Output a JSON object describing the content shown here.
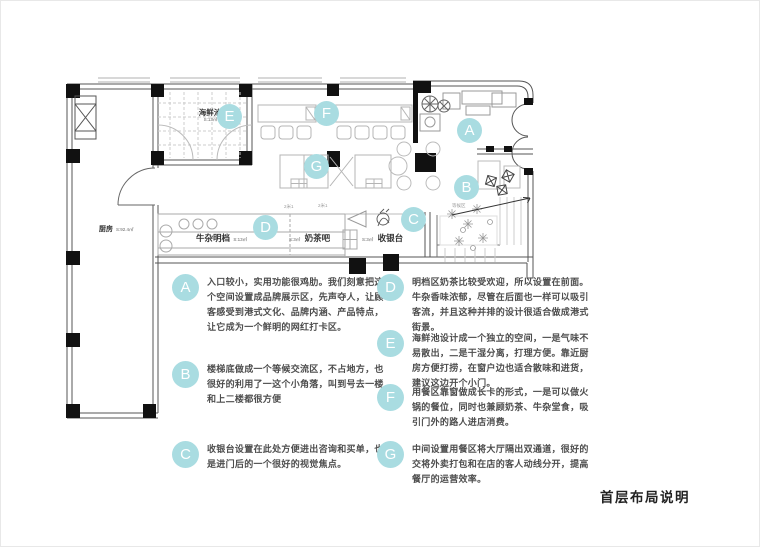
{
  "title": "首层布局说明",
  "plan": {
    "rooms": [
      {
        "name": "海鲜池",
        "area": "S:13㎡"
      },
      {
        "name": "厨房",
        "area": "S:92.4㎡"
      },
      {
        "name": "牛杂明档",
        "area": "S:13㎡"
      },
      {
        "name": "奶茶吧",
        "area": "S:3㎡"
      },
      {
        "name": "收银台",
        "area": "S:3㎡"
      }
    ],
    "markers": [
      {
        "letter": "A"
      },
      {
        "letter": "B"
      },
      {
        "letter": "C"
      },
      {
        "letter": "D"
      },
      {
        "letter": "E"
      },
      {
        "letter": "F"
      },
      {
        "letter": "G"
      }
    ],
    "tiny_labels": {
      "dim_left": "2米1",
      "dim_right": "2米1",
      "stairs_note": "等候区"
    }
  },
  "annotations": [
    {
      "letter": "A",
      "text": "入口较小，实用功能很鸡肋。我们刻意把这个空间设置成品牌展示区，先声夺人，让顾客感受到港式文化、品牌内涵、产品特点，让它成为一个鲜明的网红打卡区。"
    },
    {
      "letter": "B",
      "text": "楼梯底做成一个等候交流区，不占地方，也很好的利用了一这个小角落，叫到号去一楼和上二楼都很方便"
    },
    {
      "letter": "C",
      "text": "收银台设置在此处方便进出咨询和买单，也是进门后的一个很好的视觉焦点。"
    },
    {
      "letter": "D",
      "text": "明档区奶茶比较受欢迎，所以设置在前面。牛杂香味浓郁，尽管在后面也一样可以吸引客流，并且这种并排的设计很适合做成港式街景。"
    },
    {
      "letter": "E",
      "text": "海鲜池设计成一个独立的空间，一是气味不易散出，二是干湿分离，打理方便。靠近厨房方便打捞，在窗户边也适合散味和进货，建议这边开个小门。"
    },
    {
      "letter": "F",
      "text": "用餐区靠窗做成长卡的形式，一是可以做火锅的餐位，同时也兼顾奶茶、牛杂堂食，吸引门外的路人进店消费。"
    },
    {
      "letter": "G",
      "text": "中间设置用餐区将大厅隔出双通道，很好的交将外卖打包和在店的客人动线分开，提高餐厅的运营效率。"
    }
  ],
  "colors": {
    "marker": "#a9dce1",
    "body_text": "#4d4d4d"
  }
}
